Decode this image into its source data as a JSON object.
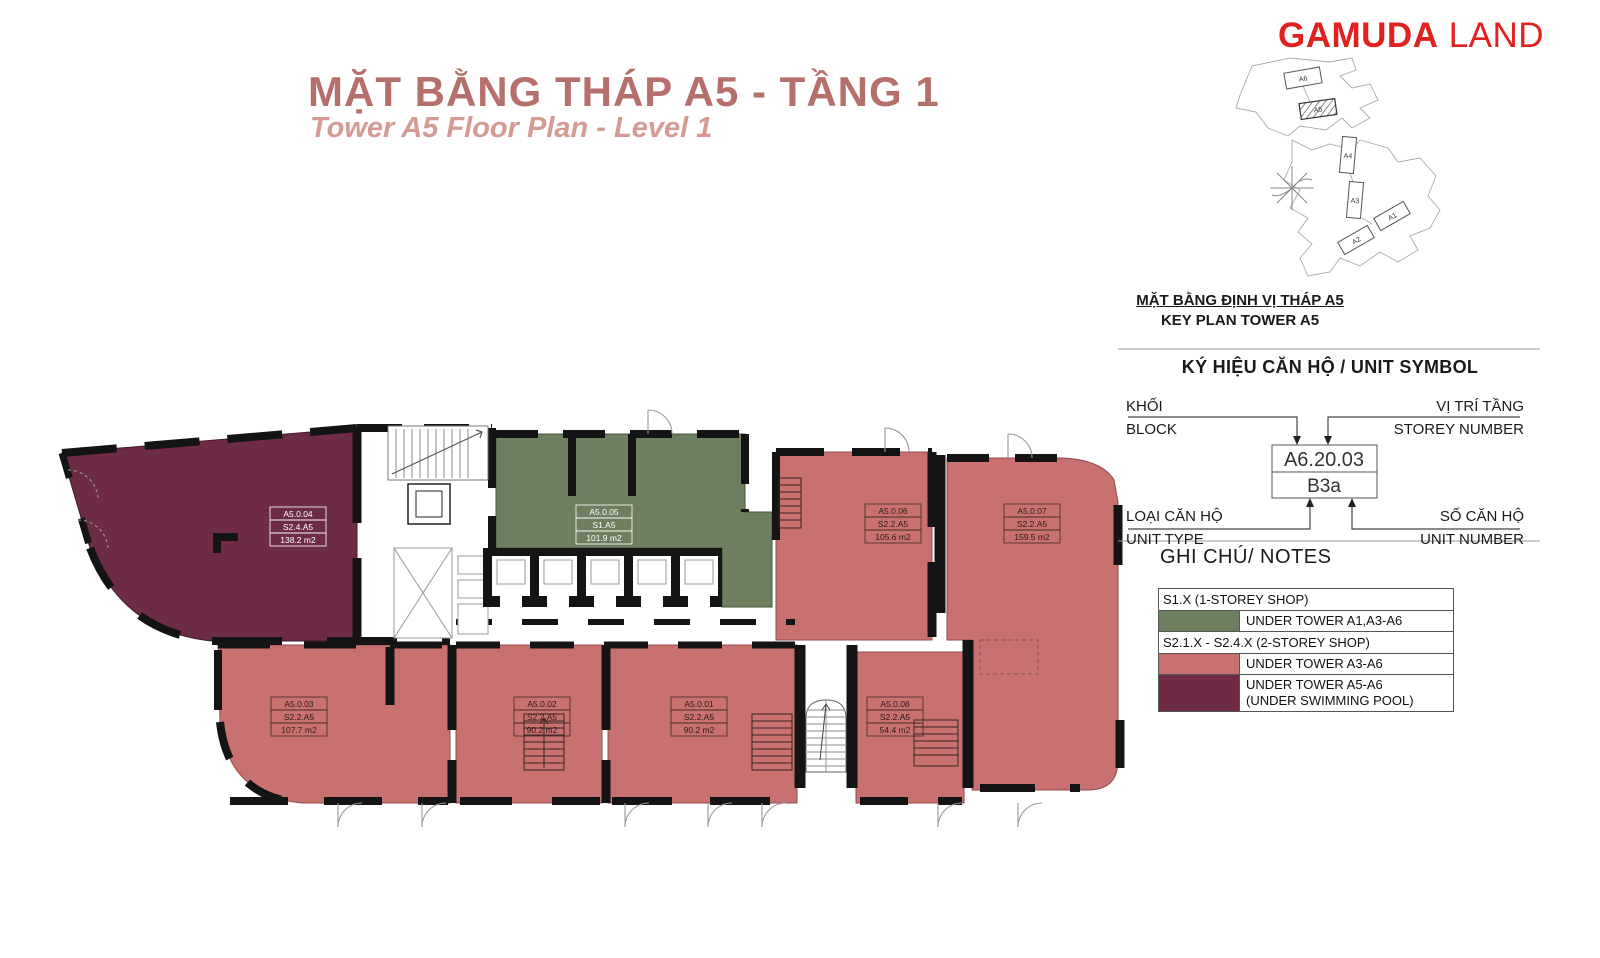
{
  "header": {
    "title_vi": "MẶT BẰNG THÁP A5 - TẦNG 1",
    "title_en": "Tower A5 Floor Plan - Level 1"
  },
  "brand": {
    "word1": "GAMUDA",
    "word2": "LAND"
  },
  "colors": {
    "title_strong": "#b5706c",
    "title_soft": "#d49a93",
    "brand_red": "#e0211f",
    "shop_1storey": "#6d7f5e",
    "shop_2storey": "#c87170",
    "shop_2storey_pool": "#6e2b45",
    "wall_black": "#141414"
  },
  "key_plan": {
    "caption_vi": "MẶT BẰNG ĐỊNH VỊ THÁP A5",
    "caption_en": "KEY PLAN TOWER A5",
    "buildings": [
      {
        "label": "A6"
      },
      {
        "label": "A5"
      },
      {
        "label": "A4"
      },
      {
        "label": "A3"
      },
      {
        "label": "A1"
      },
      {
        "label": "A2"
      }
    ],
    "highlighted": "A5"
  },
  "unit_symbol": {
    "heading": "KÝ HIỆU CĂN HỘ / UNIT SYMBOL",
    "block_vi": "KHỐI",
    "block_en": "BLOCK",
    "storey_vi": "VỊ TRÍ TẦNG",
    "storey_en": "STOREY NUMBER",
    "type_vi": "LOẠI CĂN HỘ",
    "type_en": "UNIT TYPE",
    "number_vi": "SỐ CĂN HỘ",
    "number_en": "UNIT NUMBER",
    "example_code": "A6.20.03",
    "example_type": "B3a"
  },
  "notes": {
    "heading": "GHI CHÚ/ NOTES",
    "row1": "S1.X (1-STOREY SHOP)",
    "row2": "UNDER TOWER A1,A3-A6",
    "row3": "S2.1.X - S2.4.X (2-STOREY SHOP)",
    "row4": "UNDER TOWER A3-A6",
    "row5a": "UNDER TOWER A5-A6",
    "row5b": "(UNDER SWIMMING POOL)"
  },
  "plan": {
    "units": [
      {
        "id": "A5.0.01",
        "type": "S2.2.A5",
        "area": "90.2 m2"
      },
      {
        "id": "A5.0.02",
        "type": "S2.2.A5",
        "area": "90.2 m2"
      },
      {
        "id": "A5.0.03",
        "type": "S2.2.A5",
        "area": "107.7 m2"
      },
      {
        "id": "A5.0.04",
        "type": "S2.4.A5",
        "area": "138.2 m2"
      },
      {
        "id": "A5.0.05",
        "type": "S1.A5",
        "area": "101.9 m2"
      },
      {
        "id": "A5.0.06",
        "type": "S2.2.A5",
        "area": "105.6 m2"
      },
      {
        "id": "A5.0.07",
        "type": "S2.2.A5",
        "area": "159.5 m2"
      },
      {
        "id": "A5.0.08",
        "type": "S2.2.A5",
        "area": "54.4 m2"
      }
    ]
  }
}
